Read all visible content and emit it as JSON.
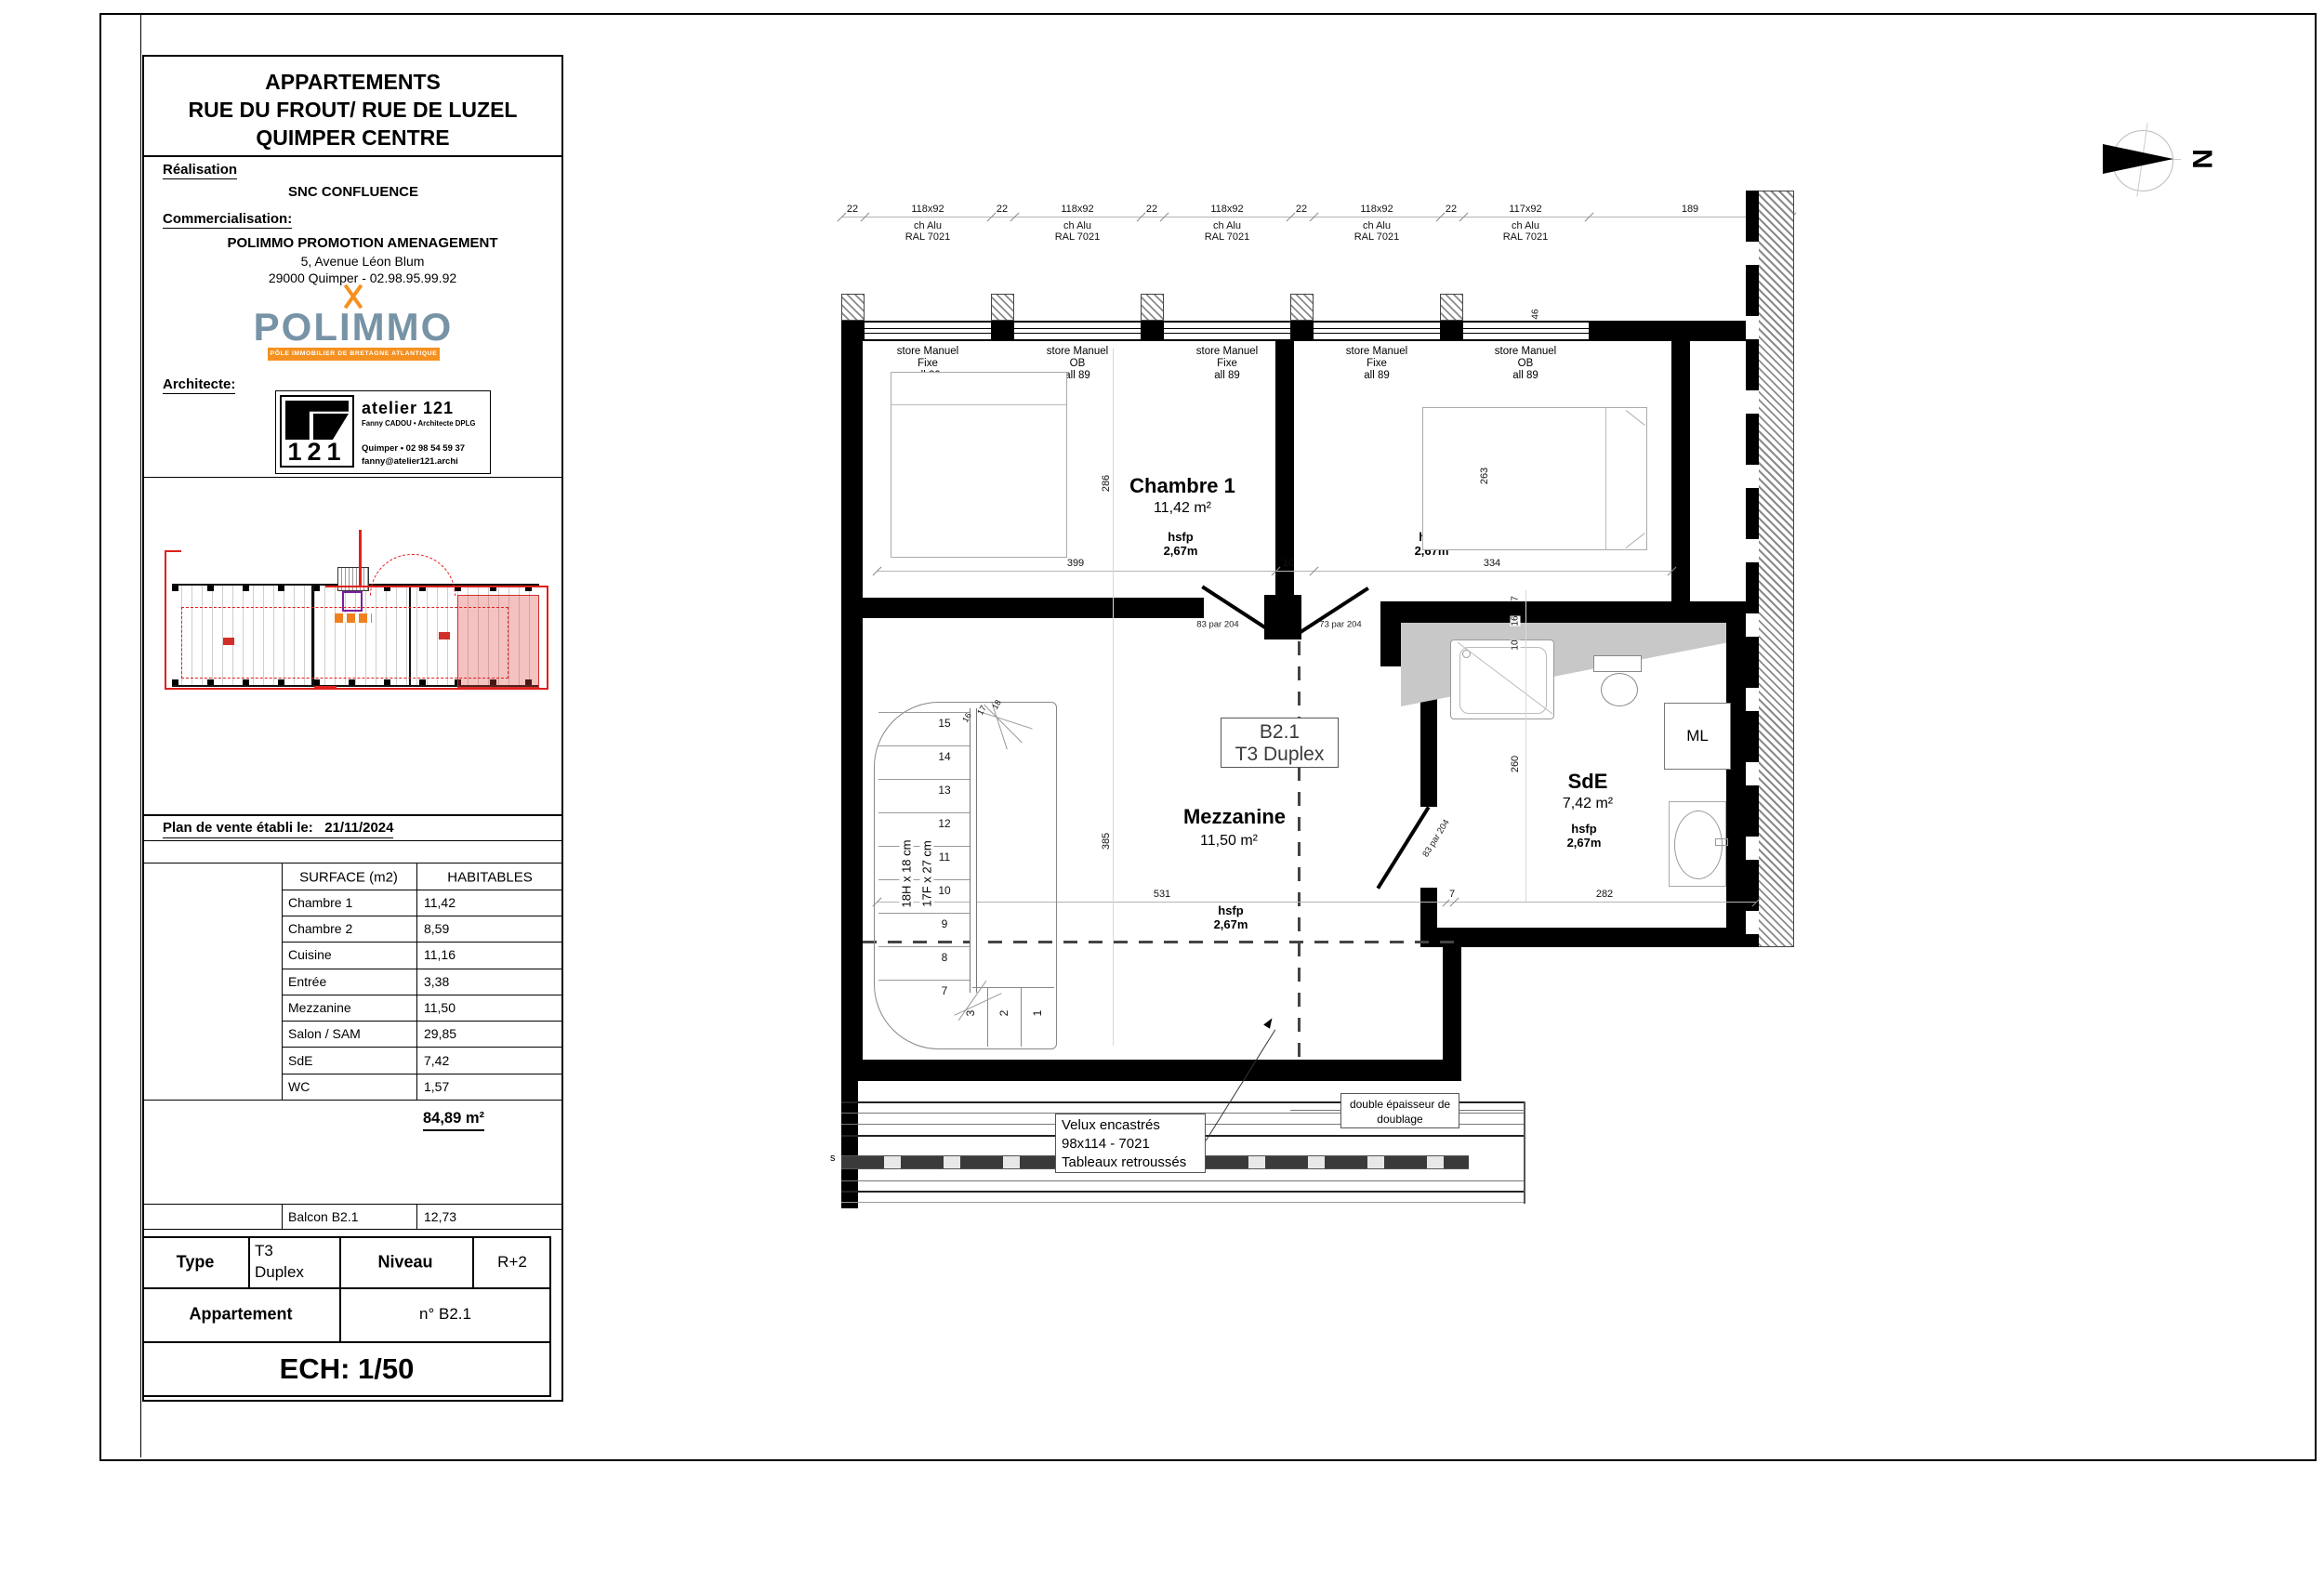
{
  "title_block": {
    "project_title": [
      "APPARTEMENTS",
      "RUE DU FROUT/ RUE DE LUZEL",
      "QUIMPER CENTRE"
    ],
    "realisation_label": "Réalisation",
    "realisation_value": "SNC CONFLUENCE",
    "commercialisation_label": "Commercialisation:",
    "commercialisation_name": "POLIMMO PROMOTION AMENAGEMENT",
    "commercialisation_address": "5, Avenue Léon Blum",
    "commercialisation_city": "29000 Quimper - 02.98.95.99.92",
    "polimmo": {
      "wordmark": "POLIMMO",
      "tagline": "PÔLE IMMOBILIER DE BRETAGNE ATLANTIQUE",
      "brand_blue": "#7793a6",
      "brand_orange": "#f59120"
    },
    "architect_label": "Architecte:",
    "architect": {
      "logo_text": "121",
      "studio": "atelier 121",
      "name": "Fanny CADOU • Architecte DPLG",
      "phone": "Quimper • 02 98 54 59 37",
      "email": "fanny@atelier121.archi"
    },
    "date_label": "Plan de vente établi le:",
    "date_value": "21/11/2024"
  },
  "surface_table": {
    "header": [
      "SURFACE (m2)",
      "HABITABLES"
    ],
    "rows": [
      [
        "Chambre 1",
        "11,42"
      ],
      [
        "Chambre 2",
        "8,59"
      ],
      [
        "Cuisine",
        "11,16"
      ],
      [
        "Entrée",
        "3,38"
      ],
      [
        "Mezzanine",
        "11,50"
      ],
      [
        "Salon / SAM",
        "29,85"
      ],
      [
        "SdE",
        "7,42"
      ],
      [
        "WC",
        "1,57"
      ]
    ],
    "total": "84,89 m²",
    "balcon": [
      "Balcon B2.1",
      "12,73"
    ]
  },
  "id_table": {
    "type_label": "Type",
    "type_value_1": "T3",
    "type_value_2": "Duplex",
    "niveau_label": "Niveau",
    "niveau_value": "R+2",
    "appartement_label": "Appartement",
    "appartement_value": "n° B2.1",
    "scale": "ECH: 1/50"
  },
  "plan": {
    "north": "N",
    "top_dims": {
      "piers": [
        "22",
        "22",
        "22",
        "22",
        "22"
      ],
      "windows": [
        {
          "size": "118x92",
          "frame": "ch Alu",
          "color": "RAL 7021"
        },
        {
          "size": "118x92",
          "frame": "ch Alu",
          "color": "RAL 7021"
        },
        {
          "size": "118x92",
          "frame": "ch Alu",
          "color": "RAL 7021"
        },
        {
          "size": "118x92",
          "frame": "ch Alu",
          "color": "RAL 7021"
        },
        {
          "size": "117x92",
          "frame": "ch Alu",
          "color": "RAL 7021"
        }
      ],
      "end": "189",
      "wall_return": "46"
    },
    "stores": [
      {
        "l1": "store Manuel",
        "l2": "Fixe",
        "l3": "all 89"
      },
      {
        "l1": "store Manuel",
        "l2": "OB",
        "l3": "all 89"
      },
      {
        "l1": "store Manuel",
        "l2": "Fixe",
        "l3": "all 89"
      },
      {
        "l1": "store Manuel",
        "l2": "Fixe",
        "l3": "all 89"
      },
      {
        "l1": "store Manuel",
        "l2": "OB",
        "l3": "all 89"
      }
    ],
    "rooms": {
      "chambre1": {
        "name": "Chambre 1",
        "area": "11,42 m²",
        "hsfp_l": "hsfp",
        "hsfp_v": "2,67m"
      },
      "chambre2": {
        "name": "Chambre 2",
        "area": "8,59 m²",
        "hsfp_l": "hsfp",
        "hsfp_v": "2,67m"
      },
      "mezzanine": {
        "name": "Mezzanine",
        "area": "11,50 m²",
        "hsfp_l": "hsfp",
        "hsfp_v": "2,67m"
      },
      "sde": {
        "name": "SdE",
        "area": "7,42 m²",
        "hsfp_l": "hsfp",
        "hsfp_v": "2,67m"
      },
      "ml": "ML"
    },
    "unit_box": {
      "line1": "B2.1",
      "line2": "T3 Duplex"
    },
    "dims": {
      "w399": "399",
      "t10": "10",
      "w334": "334",
      "h286": "286",
      "h263": "263",
      "h385": "385",
      "w531": "531",
      "t7": "7",
      "w282": "282",
      "h260": "260",
      "v7": "7",
      "v16": "16",
      "v10": "10"
    },
    "doors": {
      "left": "83 par 204",
      "right": "73 par 204",
      "sde": "83 par 204"
    },
    "stair": {
      "riser": "18H x 18 cm",
      "tread": "17F x 27 cm",
      "nums": [
        "15",
        "14",
        "13",
        "12",
        "11",
        "10",
        "9",
        "8",
        "7"
      ],
      "low": [
        "3",
        "2",
        "1"
      ],
      "high": [
        "16",
        "17",
        "18"
      ]
    },
    "notes": {
      "velux": [
        "Velux encastrés",
        "98x114 - 7021",
        "Tableaux retroussés"
      ],
      "doublage": [
        "double épaisseur de",
        "doublage"
      ],
      "section": "s"
    }
  }
}
